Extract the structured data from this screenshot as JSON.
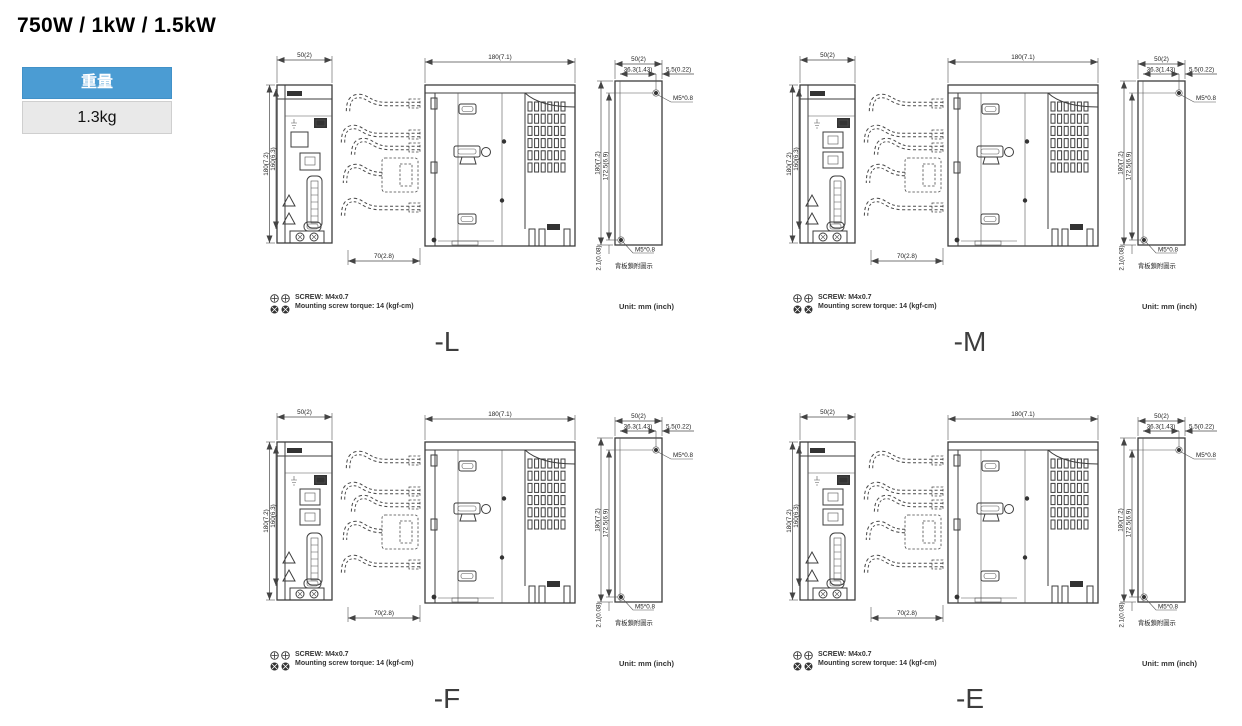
{
  "page": {
    "title": "750W / 1kW / 1.5kW"
  },
  "weight": {
    "label": "重量",
    "value": "1.3kg"
  },
  "dims": {
    "front_width": "50(2)",
    "front_height_outer": "180(7.2)",
    "front_height_inner": "160(6.3)",
    "side_width": "180(7.1)",
    "cable_depth": "70(2.8)",
    "back_width": "50(2)",
    "hole_span": "36.3(1.43)",
    "hole_edge_offset": "5.5(0.22)",
    "back_height_outer": "180(7.2)",
    "hole_pitch": "172.5(6.9)",
    "bottom_offset": "2.1(0.08)",
    "screw_top": "M5*0.8",
    "screw_bottom": "M5*0.8",
    "back_note": "背板鎖附圖示"
  },
  "notes": {
    "screw": "SCREW: M4x0.7",
    "torque": "Mounting screw torque: 14 (kgf-cm)",
    "unit": "Unit: mm (inch)"
  },
  "variants": [
    {
      "label": "-L",
      "single_port": true,
      "dual_port": false
    },
    {
      "label": "-M",
      "single_port": false,
      "dual_port": true
    },
    {
      "label": "-F",
      "single_port": false,
      "dual_port": true
    },
    {
      "label": "-E",
      "single_port": false,
      "dual_port": true
    }
  ],
  "colors": {
    "header_blue": "#4B9CD3",
    "value_gray": "#E9E9E9",
    "line": "#3D3D3D",
    "text": "#222222"
  }
}
